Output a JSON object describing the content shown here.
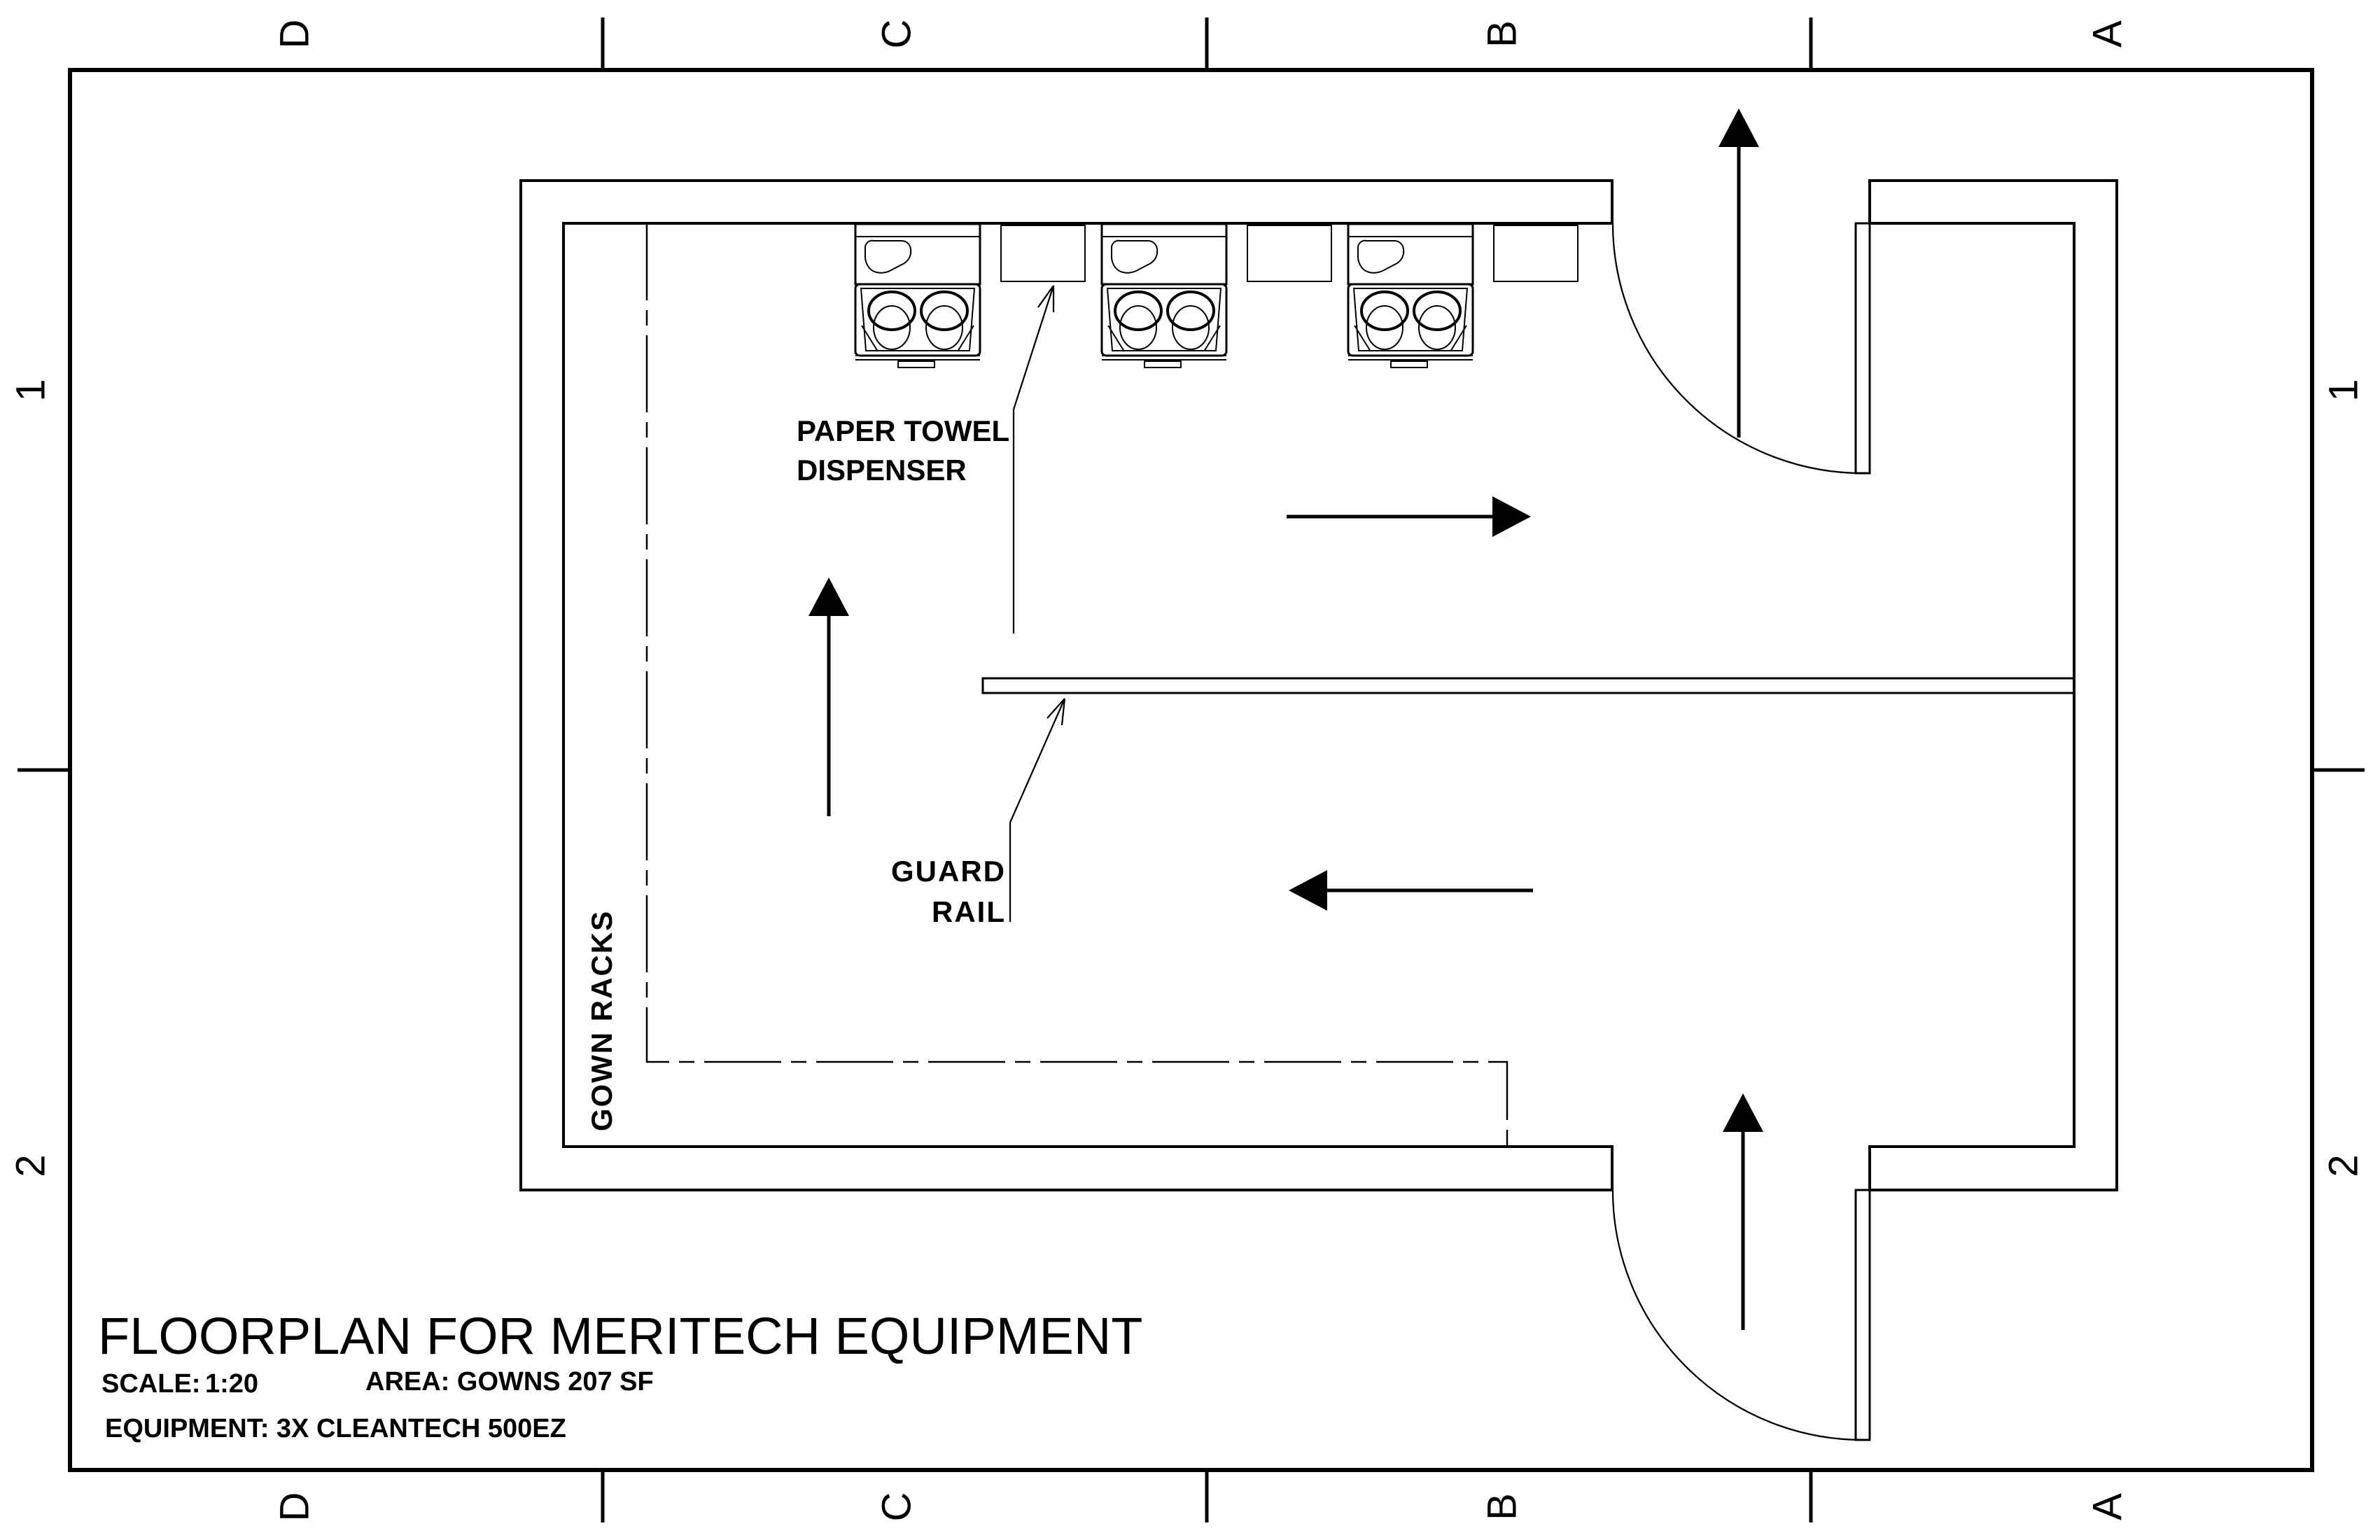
{
  "sheet": {
    "title": "FLOORPLAN FOR MERITECH EQUIPMENT",
    "scale_label": "SCALE:",
    "scale_value": "1:20",
    "area_line": "AREA: GOWNS 207 SF",
    "equipment_line": "EQUIPMENT: 3X CLEANTECH 500EZ"
  },
  "grid": {
    "cols": [
      "D",
      "C",
      "B",
      "A"
    ],
    "rows": [
      "1",
      "2"
    ]
  },
  "annotations": {
    "paper_towel_line1": "PAPER TOWEL",
    "paper_towel_line2": "DISPENSER",
    "guard_rail_line1": "GUARD",
    "guard_rail_line2": "RAIL",
    "gown_racks": "GOWN RACKS"
  },
  "equipment": {
    "wash_station": "cleantech-500ez-handwash-station",
    "wash_station_count": 3,
    "towel_dispenser_count": 3
  },
  "colors": {
    "ink": "#000000",
    "paper": "#ffffff"
  }
}
